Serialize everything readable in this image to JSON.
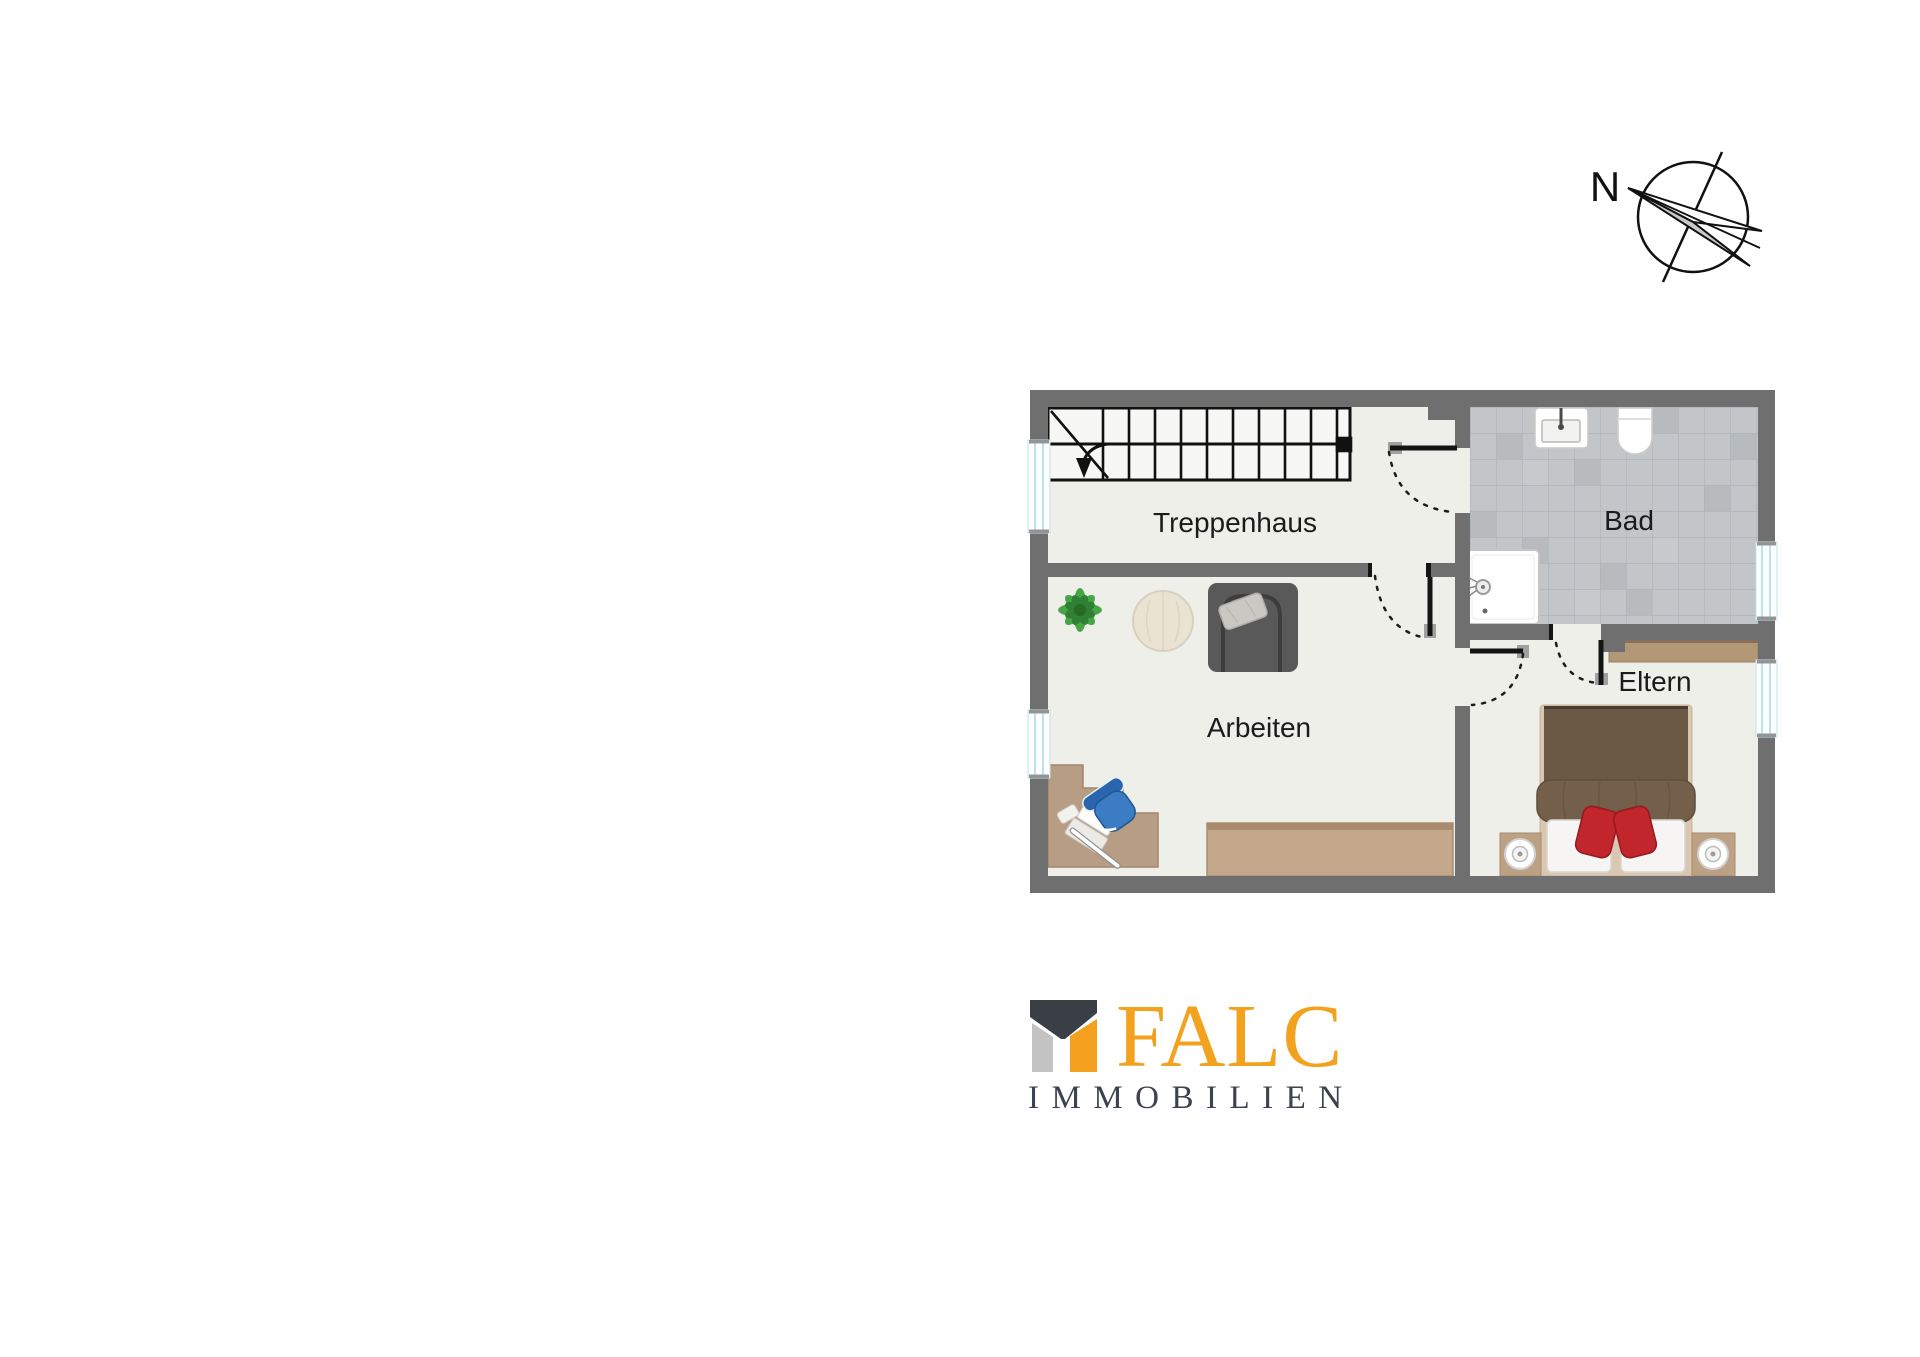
{
  "compass": {
    "north_label": "N"
  },
  "floorplan": {
    "rooms": [
      {
        "id": "treppenhaus",
        "name": "Treppenhaus"
      },
      {
        "id": "bad",
        "name": "Bad"
      },
      {
        "id": "arbeiten",
        "name": "Arbeiten"
      },
      {
        "id": "eltern",
        "name": "Eltern"
      }
    ],
    "fixtures": [
      "staircase",
      "stair-direction-arrow",
      "sink",
      "toilet",
      "shower",
      "plant",
      "side-table",
      "armchair",
      "corner-desk",
      "laptop",
      "office-chair",
      "sideboard",
      "wardrobe",
      "double-bed",
      "red-pillows",
      "white-pillows",
      "nightstand-left",
      "nightstand-right",
      "window",
      "door-swing"
    ],
    "colors": {
      "wall": "#6F6F6F",
      "floor": "#EDEFE8",
      "bath_tile": "#C2C6C9",
      "tile_line": "#AAB1B6",
      "wood": "#B79D84",
      "sideboard_wood": "#C3A88C",
      "bed_blanket": "#6B5946",
      "pillow_red": "#C0262B",
      "chair_blue": "#3B7CC4",
      "plant_green": "#46A546",
      "window_glass": "#B5E3EF",
      "line_black": "#141414"
    }
  },
  "logo": {
    "brand": "FALC",
    "subtitle": "IMMOBILIEN",
    "brand_color": "#F2A21D",
    "subtitle_color": "#3C434E",
    "icon": {
      "roof_color": "#3A3F46",
      "left_color": "#C3C3C3",
      "right_color": "#F5A01E"
    }
  }
}
